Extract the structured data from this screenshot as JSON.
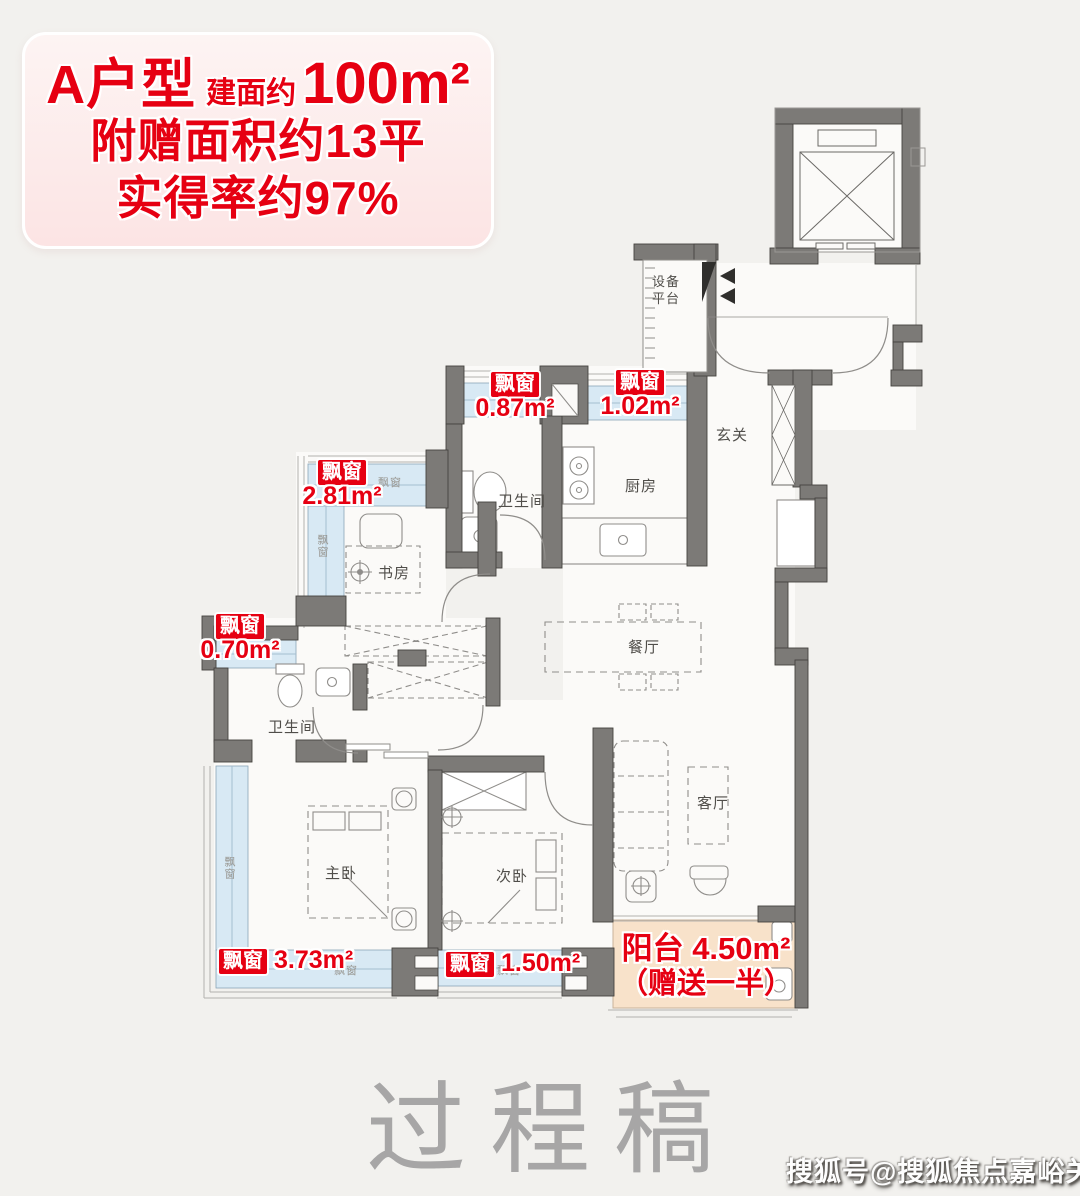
{
  "title_card": {
    "unit_name": "A户型",
    "area_prefix": "建面约",
    "area_value": "100m²",
    "bonus_line": "附赠面积约13平",
    "rate_line": "实得率约97%"
  },
  "rooms": {
    "equipment_platform": "设备平台",
    "foyer": "玄关",
    "kitchen": "厨房",
    "bathroom": "卫生间",
    "study": "书房",
    "dining": "餐厅",
    "living": "客厅",
    "master_bedroom": "主卧",
    "second_bedroom": "次卧"
  },
  "bay_windows": {
    "badge": "飘窗",
    "items": [
      {
        "value": "0.87m²"
      },
      {
        "value": "1.02m²"
      },
      {
        "value": "2.81m²"
      },
      {
        "value": "0.70m²"
      },
      {
        "value": "3.73m²"
      },
      {
        "value": "1.50m²"
      }
    ]
  },
  "balcony": {
    "line1": "阳台 4.50m²",
    "line2": "（赠送一半）"
  },
  "small_labels": {
    "bay": "飘窗"
  },
  "watermarks": {
    "center": "过程稿",
    "corner": "搜狐号@搜狐焦点嘉峪关站"
  },
  "colors": {
    "accent_red": "#e60012",
    "bay_blue": "#d8e9f4",
    "balcony_orange": "#f8e2ca",
    "wall_gray": "#7c7a77",
    "background": "#f2f1ee"
  }
}
